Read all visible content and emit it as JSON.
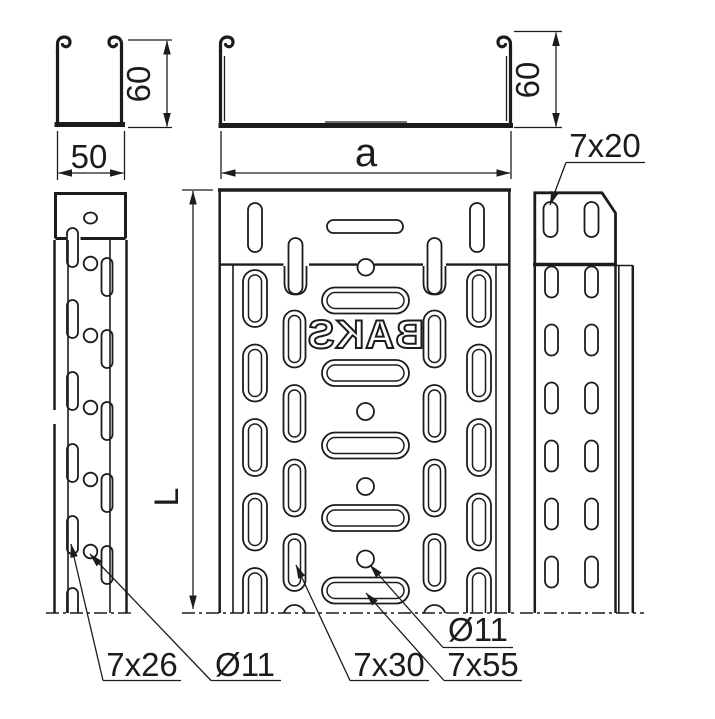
{
  "drawing": {
    "brand_mark": "BAKS",
    "colors": {
      "line": "#1c1c1c",
      "background": "#ffffff"
    },
    "section_small": {
      "width": "50",
      "height": "60"
    },
    "section_wide": {
      "width": "a",
      "height": "60"
    },
    "side_left": {
      "length": "L",
      "slot": "7x26",
      "hole": "Ø11"
    },
    "plan": {
      "slot_inner": "7x30",
      "slot_center": "7x55",
      "hole": "Ø11"
    },
    "side_right": {
      "slot": "7x20"
    }
  }
}
